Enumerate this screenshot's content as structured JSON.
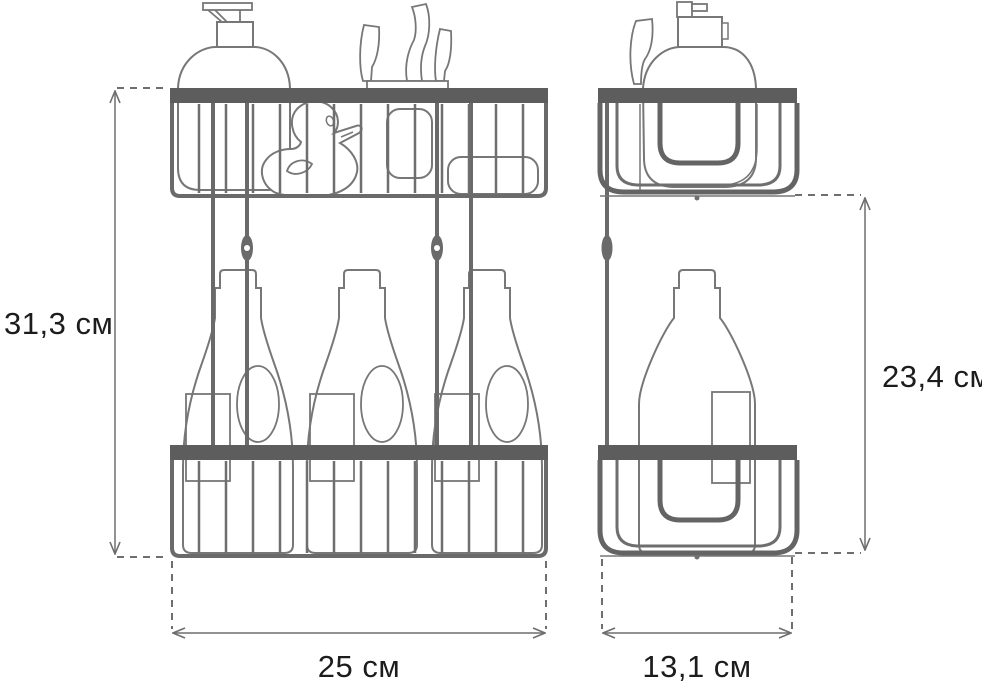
{
  "drawing": {
    "title_semantic": "two-tier shower caddy dimension drawing",
    "views": {
      "left": "front view",
      "right": "side view"
    }
  },
  "dimensions": {
    "overall_height": "31,3 см",
    "hanging_height": "23,4 см",
    "width": "25 см",
    "depth": "13,1 см"
  },
  "colors": {
    "background": "#ffffff",
    "rail": "#5d5d5d",
    "wire": "#6e6e6e",
    "outline": "#777777",
    "dimension_line": "#6e6e6e",
    "text": "#1c1c1c"
  }
}
